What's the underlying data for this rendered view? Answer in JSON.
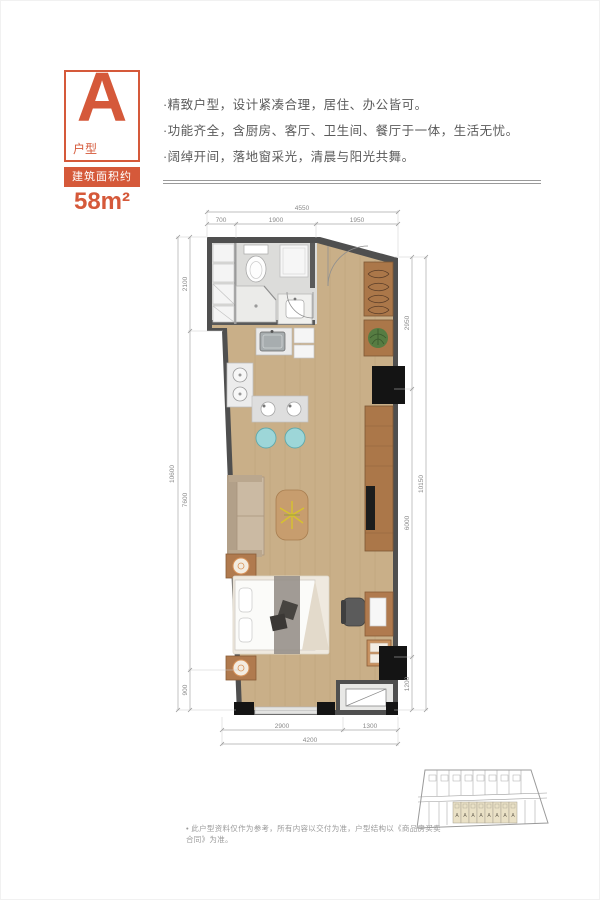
{
  "unit": {
    "letter": "A",
    "type_label": "户型",
    "area_label": "建筑面积约",
    "area_value": "58m²"
  },
  "features": [
    "·精致户型，设计紧凑合理，居住、办公皆可。",
    "·功能齐全，含厨房、客厅、卫生间、餐厅于一体，生活无忧。",
    "·阔绰开间，落地窗采光，清晨与阳光共舞。"
  ],
  "plan": {
    "dims": {
      "top_total": "4550",
      "top_segments": [
        "700",
        "1900",
        "1950"
      ],
      "left_total": "10600",
      "left_segments": [
        "2100",
        "7600",
        "900"
      ],
      "right_total": "10150",
      "right_segments": [
        "2950",
        "6000",
        "1200"
      ],
      "bottom_total": "4200",
      "bottom_segments": [
        "2900",
        "1300"
      ]
    }
  },
  "key_plan": {
    "units": [
      "A",
      "A",
      "A",
      "A",
      "A",
      "A",
      "A",
      "A"
    ]
  },
  "footnote": "• 此户型资料仅作为参考，所有内容以交付为准，户型结构以《商品房买卖合同》为准。",
  "colors": {
    "accent": "#d5593a",
    "wall": "#4f4f4f",
    "wood_floor": "#c9af88",
    "cabinet_brown": "#ab7749",
    "stool_teal": "#9dd6d8"
  }
}
